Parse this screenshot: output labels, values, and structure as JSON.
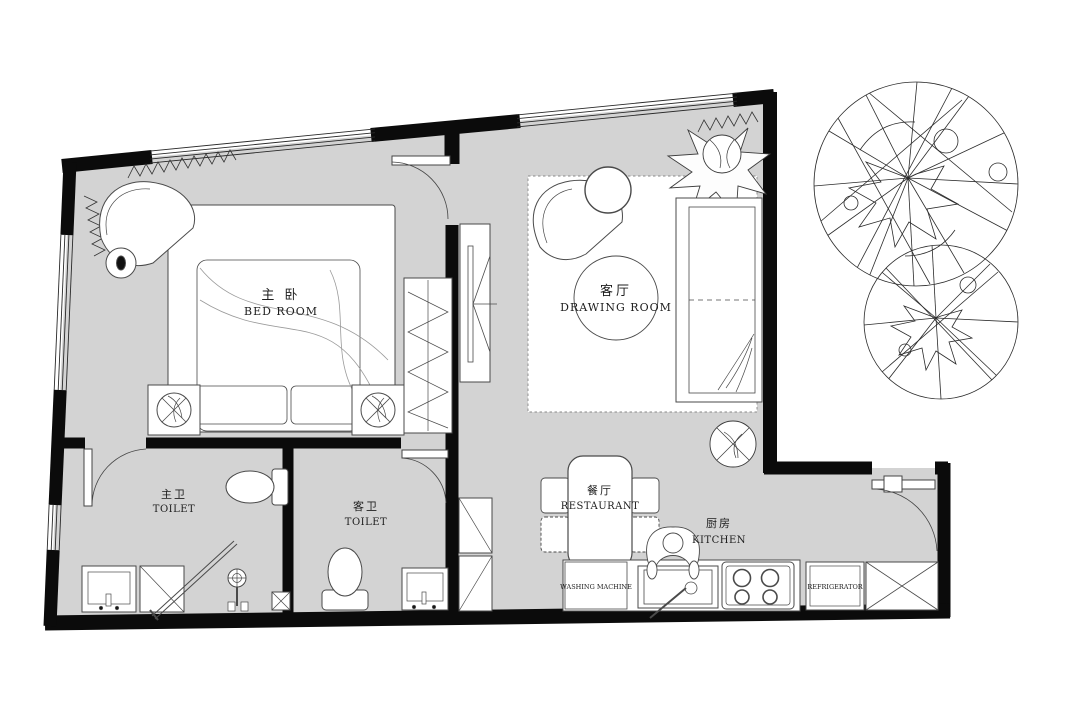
{
  "plan_title": "apartment-floor-plan",
  "rooms": {
    "bedroom": {
      "zh": "主 卧",
      "en": "BED ROOM"
    },
    "drawing_room": {
      "zh": "客厅",
      "en": "DRAWING ROOM"
    },
    "master_toilet": {
      "zh": "主卫",
      "en": "TOILET"
    },
    "guest_toilet": {
      "zh": "客卫",
      "en": "TOILET"
    },
    "dining": {
      "zh": "餐厅",
      "en": "RESTAURANT"
    },
    "kitchen": {
      "zh": "厨房",
      "en": "KITCHEN"
    }
  },
  "appliances": {
    "washing_machine": "WASHING MACHINE",
    "refrigerator": "REFRIGERATOR"
  },
  "colors": {
    "floor": "#d3d3d3",
    "wall": "#0b0b0b",
    "furniture_line": "#3a3a3a",
    "background": "#ffffff"
  }
}
